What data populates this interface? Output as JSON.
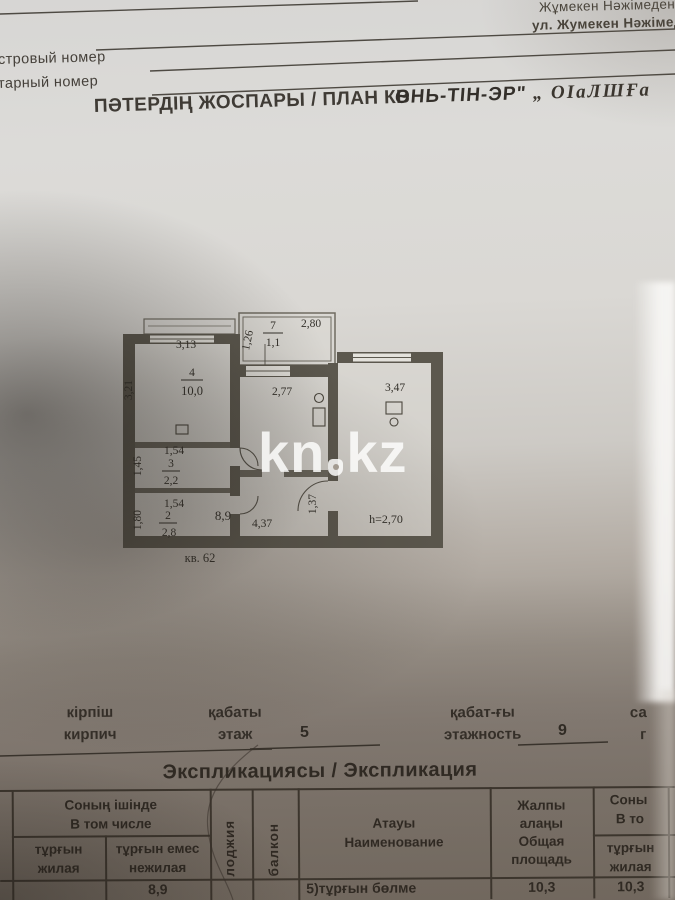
{
  "header": {
    "address_line1": "Жұмекен Нәжімедено",
    "address_line2": "ул. Жумекен Нәжімед",
    "field1_label": "стровый номер",
    "field2_label": "тарный номер",
    "title": "ПӘТЕРДІҢ ЖОСПАРЫ / ПЛАН КВ",
    "title_overlay1": "ѲНЬ-ТІН-ЭР\"",
    "title_overlay2": "„ ОІаЛШҒа"
  },
  "plan": {
    "watermark_part1": "kn",
    "watermark_part2": "kz",
    "apartment_label": "кв. 62",
    "ceiling_height": "h=2,70",
    "dims": {
      "r4_top": "3,13",
      "r4_left": "3,21",
      "r4_num": "4",
      "r4_area": "10,0",
      "r7_left": "1,26",
      "r7_num": "7",
      "r7_area": "1,1",
      "r7_top": "2,80",
      "kitchen_top": "2,77",
      "living_top": "3,47",
      "r3_top": "1,54",
      "r3_left": "1,45",
      "r3_num": "3",
      "r3_area": "2,2",
      "r2_top": "1,54",
      "r2_left": "1,80",
      "r2_num": "2",
      "r2_area": "2,8",
      "hall_area": "8,9",
      "hall_bottom": "4,37",
      "hall_right": "1,37"
    }
  },
  "building": {
    "material_kk": "кірпіш",
    "material_ru": "кирпич",
    "floor_kk": "қабаты",
    "floor_ru": "этаж",
    "floor_value": "5",
    "storeys_kk": "қабат-ғы",
    "storeys_ru": "этажность",
    "storeys_value": "9",
    "right_fragment_top": "са",
    "right_fragment_bottom": "г"
  },
  "explication": {
    "title": "Экспликациясы / Экспликация",
    "including_kk": "Соның ішінде",
    "including_ru": "В том числе",
    "living_kk": "тұрғын",
    "living_ru": "жилая",
    "nonliving_kk": "тұрғын емес",
    "nonliving_ru": "нежилая",
    "loggia": "лоджия",
    "balcony": "балкон",
    "name_kk": "Атауы",
    "name_ru": "Наименование",
    "total_kk1": "Жалпы",
    "total_kk2": "алаңы",
    "total_ru1": "Общая",
    "total_ru2": "площадь",
    "right_including_kk": "Соны",
    "right_including_ru": "В то",
    "right_living_kk": "тұрғын",
    "right_living_ru": "жилая",
    "row": {
      "nonliving": "8,9",
      "name": "5)тұрғын бөлме",
      "total": "10,3",
      "living": "10,3"
    }
  }
}
